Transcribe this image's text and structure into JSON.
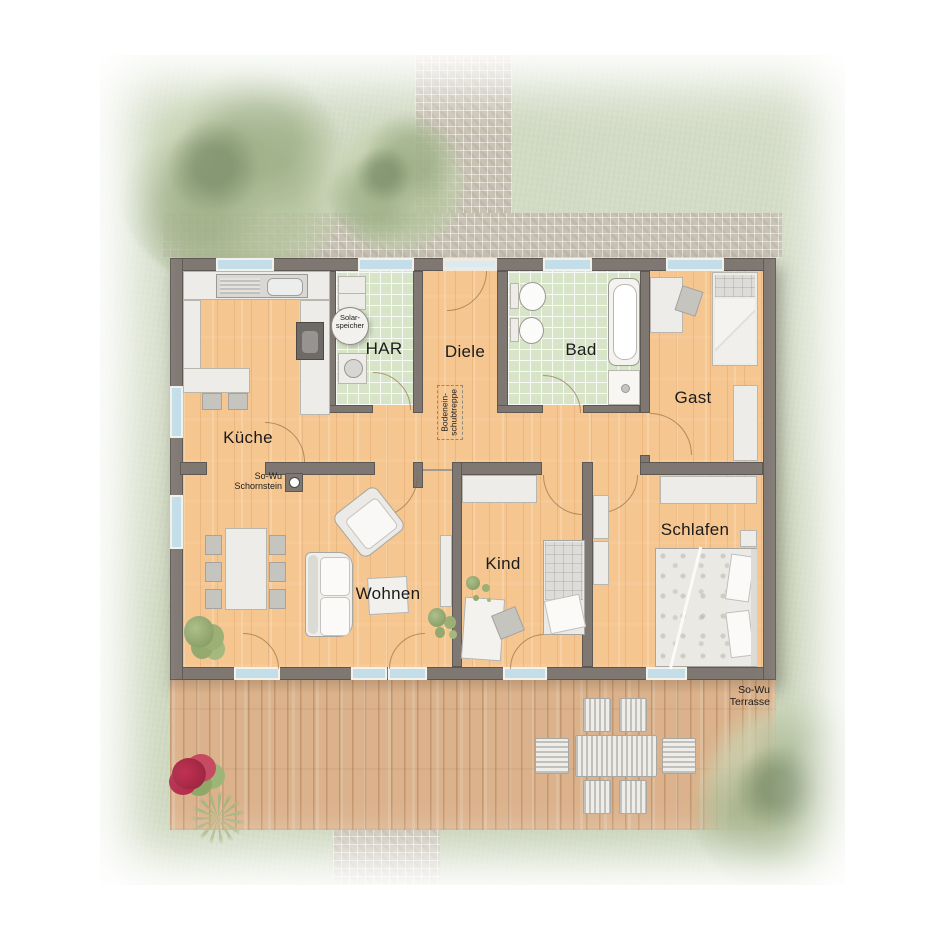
{
  "rooms": {
    "kueche": "Küche",
    "har": "HAR",
    "diele": "Diele",
    "bad": "Bad",
    "gast": "Gast",
    "wohnen": "Wohnen",
    "kind": "Kind",
    "schlafen": "Schlafen"
  },
  "annotations": {
    "solar": {
      "line1": "Solar-",
      "line2": "speicher"
    },
    "loft_stairs": {
      "line1": "Bodenein-",
      "line2": "schubtreppe"
    },
    "chimney": {
      "line1": "So-Wu",
      "line2": "Schornstein"
    },
    "terrace": {
      "line1": "So-Wu",
      "line2": "Terrasse"
    }
  },
  "colors": {
    "wall": "#7f7872",
    "floor_wood": "#f5c690",
    "terrace_wood": "#dbb28b",
    "tile_green": "#d7e4c8",
    "grass": "#ccd6bd",
    "path": "#c8c2b4",
    "window_glass": "#c3dee9",
    "furniture_white": "#edece8",
    "flower_red": "#c13052",
    "text": "#1b1b1b"
  }
}
